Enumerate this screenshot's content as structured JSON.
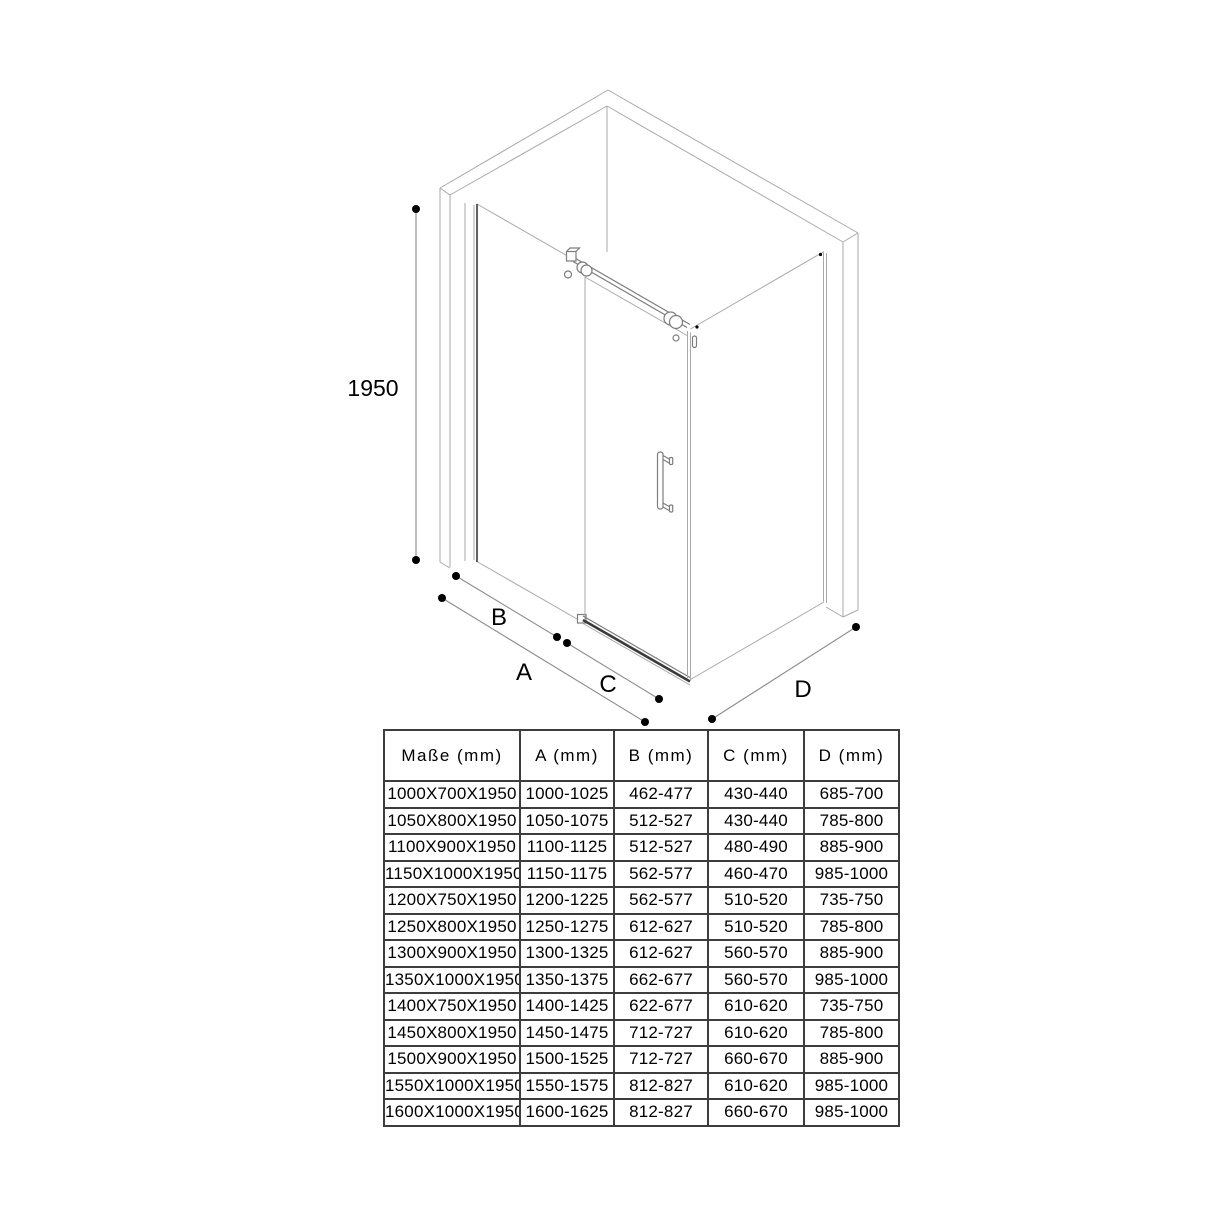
{
  "diagram": {
    "height_label": "1950",
    "labels": {
      "a": "A",
      "b": "B",
      "c": "C",
      "d": "D"
    }
  },
  "table": {
    "headers": [
      "Maße (mm)",
      "A (mm)",
      "B (mm)",
      "C (mm)",
      "D (mm)"
    ],
    "rows": [
      [
        "1000X700X1950",
        "1000-1025",
        "462-477",
        "430-440",
        "685-700"
      ],
      [
        "1050X800X1950",
        "1050-1075",
        "512-527",
        "430-440",
        "785-800"
      ],
      [
        "1100X900X1950",
        "1100-1125",
        "512-527",
        "480-490",
        "885-900"
      ],
      [
        "1150X1000X1950",
        "1150-1175",
        "562-577",
        "460-470",
        "985-1000"
      ],
      [
        "1200X750X1950",
        "1200-1225",
        "562-577",
        "510-520",
        "735-750"
      ],
      [
        "1250X800X1950",
        "1250-1275",
        "612-627",
        "510-520",
        "785-800"
      ],
      [
        "1300X900X1950",
        "1300-1325",
        "612-627",
        "560-570",
        "885-900"
      ],
      [
        "1350X1000X1950",
        "1350-1375",
        "662-677",
        "560-570",
        "985-1000"
      ],
      [
        "1400X750X1950",
        "1400-1425",
        "622-677",
        "610-620",
        "735-750"
      ],
      [
        "1450X800X1950",
        "1450-1475",
        "712-727",
        "610-620",
        "785-800"
      ],
      [
        "1500X900X1950",
        "1500-1525",
        "712-727",
        "660-670",
        "885-900"
      ],
      [
        "1550X1000X1950",
        "1550-1575",
        "812-827",
        "610-620",
        "985-1000"
      ],
      [
        "1600X1000X1950",
        "1600-1625",
        "812-827",
        "660-670",
        "985-1000"
      ]
    ]
  }
}
